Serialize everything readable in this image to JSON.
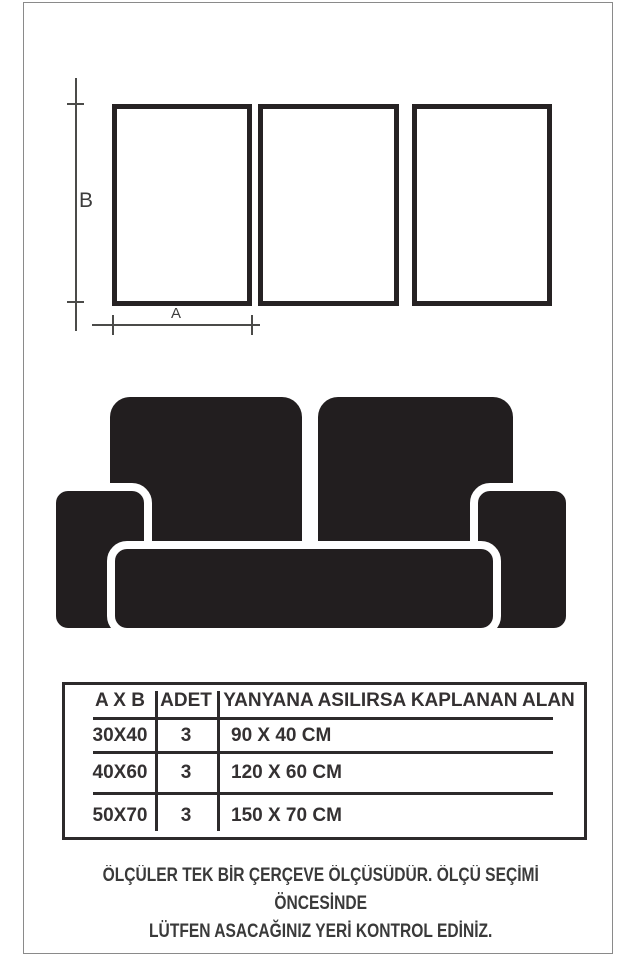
{
  "diagram": {
    "width_label": "A",
    "height_label": "B",
    "frame_count": 3
  },
  "size_table": {
    "headers": {
      "size": "A X B",
      "qty": "ADET",
      "area": "YANYANA ASILIRSA KAPLANAN ALAN"
    },
    "rows": [
      {
        "size": "30X40",
        "qty": "3",
        "area": "90 X 40 CM"
      },
      {
        "size": "40X60",
        "qty": "3",
        "area": "120 X 60 CM"
      },
      {
        "size": "50X70",
        "qty": "3",
        "area": "150 X 70 CM"
      }
    ]
  },
  "footer": {
    "line1": "ÖLÇÜLER TEK BİR ÇERÇEVE ÖLÇÜSÜDÜR. ÖLÇÜ SEÇİMİ ÖNCESİNDE",
    "line2": "LÜTFEN ASACAĞINIZ YERİ KONTROL EDİNİZ."
  },
  "colors": {
    "ink_black": "#221e1f",
    "frame_border": "#262223",
    "dimension_line": "#4b4b49",
    "table_line": "#2d2a2b",
    "page_border": "#8a8a8a",
    "text": "#343132"
  }
}
